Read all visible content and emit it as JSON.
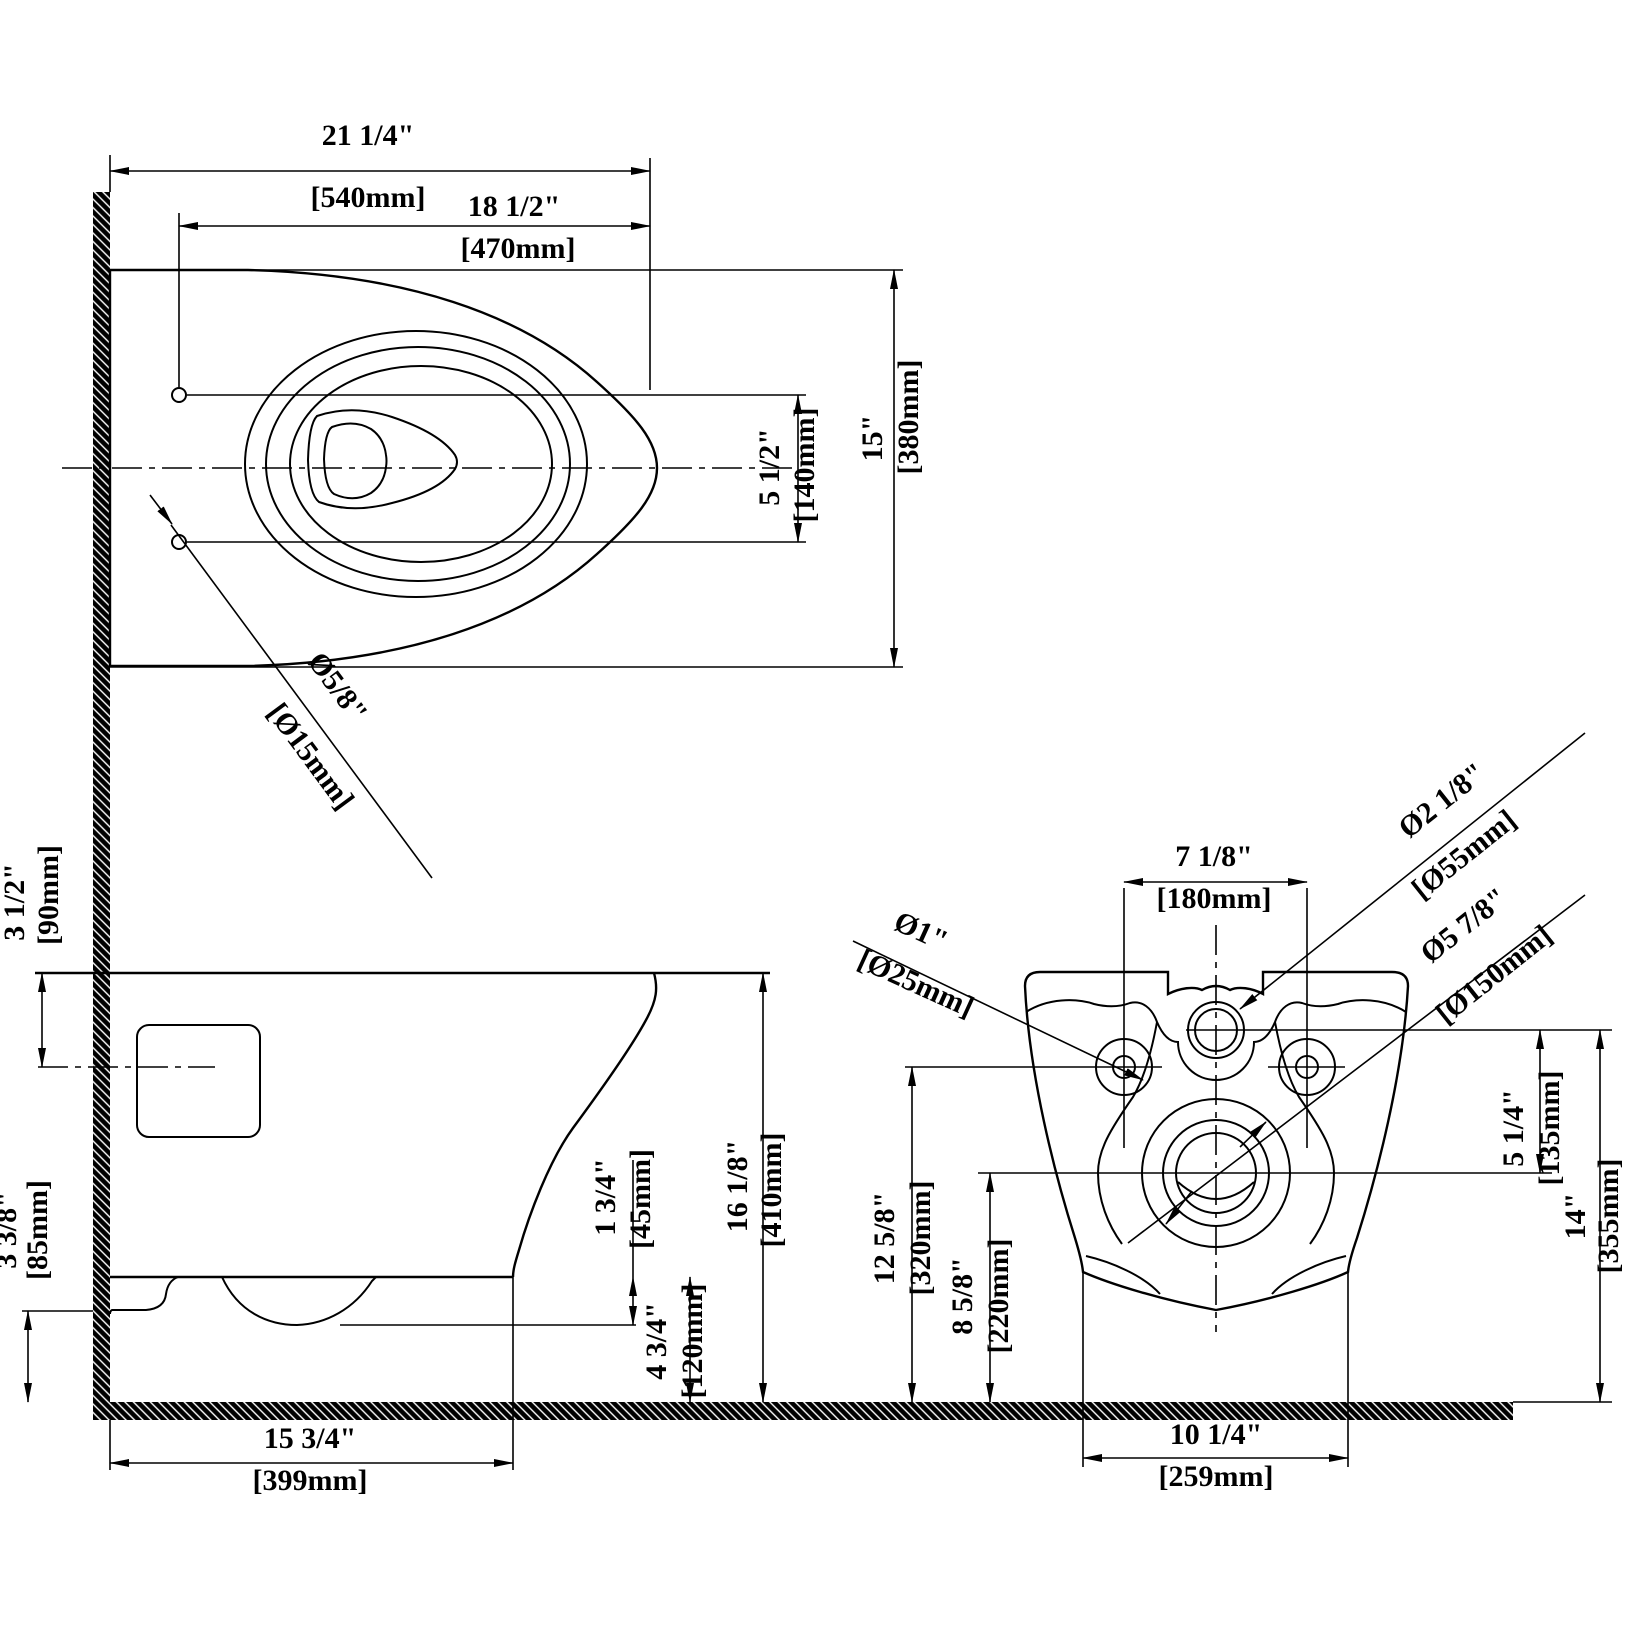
{
  "drawing": {
    "background_color": "#ffffff",
    "line_color": "#000000"
  },
  "dims": {
    "d540": {
      "in": "21 1/4\"",
      "mm": "[540mm]"
    },
    "d470": {
      "in": "18 1/2\"",
      "mm": "[470mm]"
    },
    "d380": {
      "in": "15\"",
      "mm": "[380mm]"
    },
    "d140": {
      "in": "5 1/2\"",
      "mm": "[140mm]"
    },
    "d15": {
      "in": "Ø5/8\"",
      "mm": "[Ø15mm]"
    },
    "d90": {
      "in": "3 1/2\"",
      "mm": "[90mm]"
    },
    "d85": {
      "in": "3 3/8\"",
      "mm": "[85mm]"
    },
    "d45": {
      "in": "1 3/4\"",
      "mm": "[45mm]"
    },
    "d120": {
      "in": "4 3/4\"",
      "mm": "[120mm]"
    },
    "d410": {
      "in": "16 1/8\"",
      "mm": "[410mm]"
    },
    "d399": {
      "in": "15 3/4\"",
      "mm": "[399mm]"
    },
    "d180": {
      "in": "7 1/8\"",
      "mm": "[180mm]"
    },
    "d55": {
      "in": "Ø2 1/8\"",
      "mm": "[Ø55mm]"
    },
    "d25": {
      "in": "Ø1\"",
      "mm": "[Ø25mm]"
    },
    "d150": {
      "in": "Ø5 7/8\"",
      "mm": "[Ø150mm]"
    },
    "d135": {
      "in": "5 1/4\"",
      "mm": "[135mm]"
    },
    "d320": {
      "in": "12 5/8\"",
      "mm": "[320mm]"
    },
    "d220": {
      "in": "8 5/8\"",
      "mm": "[220mm]"
    },
    "d355": {
      "in": "14\"",
      "mm": "[355mm]"
    },
    "d259": {
      "in": "10 1/4\"",
      "mm": "[259mm]"
    }
  }
}
